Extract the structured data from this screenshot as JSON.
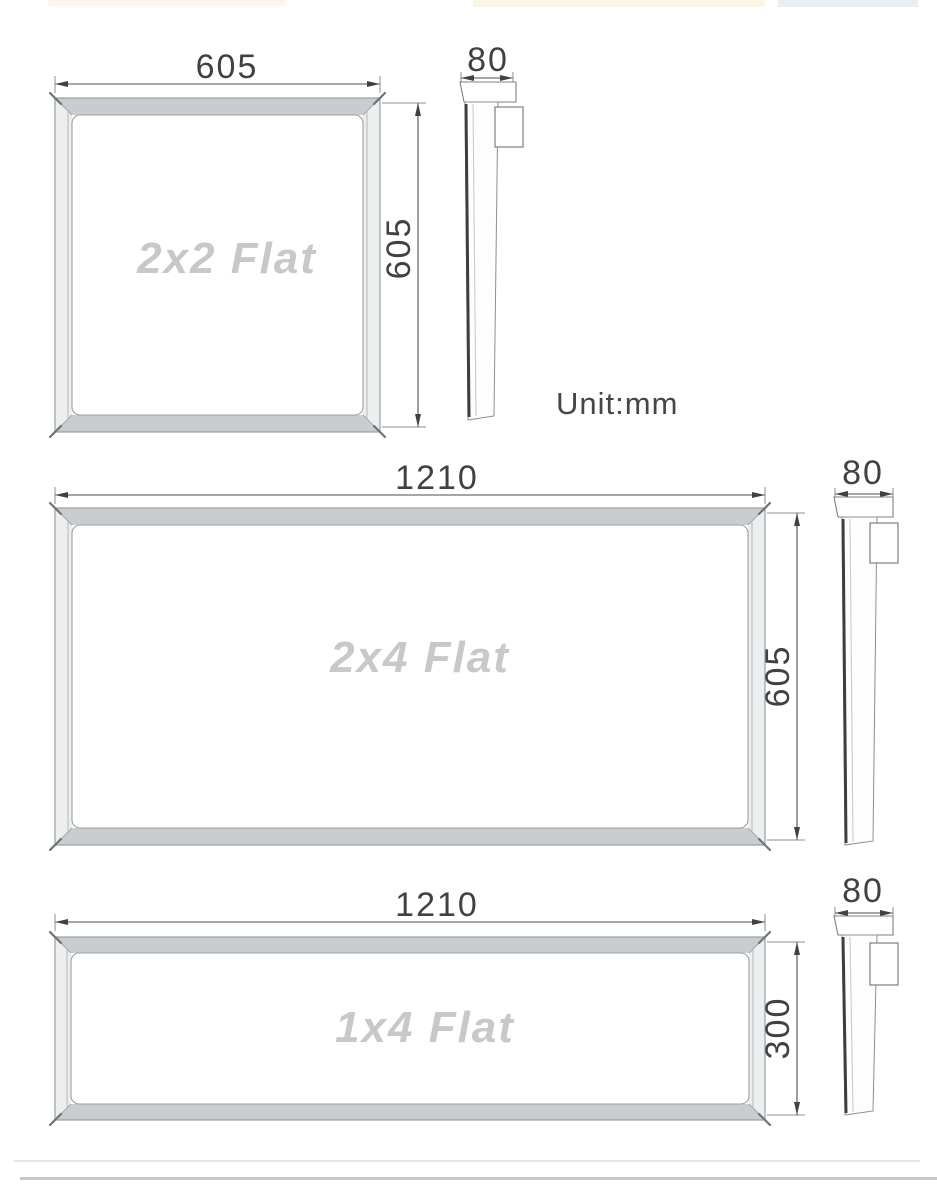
{
  "page": {
    "unit_label": "Unit:mm"
  },
  "panels": [
    {
      "id": "2x2",
      "label": "2x2 Flat",
      "width_mm": "605",
      "height_mm": "605",
      "depth_mm": "80"
    },
    {
      "id": "2x4",
      "label": "2x4 Flat",
      "width_mm": "1210",
      "height_mm": "605",
      "depth_mm": "80"
    },
    {
      "id": "1x4",
      "label": "1x4 Flat",
      "width_mm": "1210",
      "height_mm": "300",
      "depth_mm": "80"
    }
  ],
  "colors": {
    "dimension_line": "#4a4e50",
    "dimension_text": "#3f4244",
    "frame_outline": "#9aa0a2",
    "frame_band_fill": "#c9cdcf",
    "frame_side_fill": "#eceeef",
    "panel_label_text": "#c8c8c8",
    "profile_dark_edge": "#3b3f41",
    "divider_line": "#c7c7c7",
    "top_strip_cream": "#fbf6e3",
    "top_strip_blue": "#e9eef6"
  }
}
